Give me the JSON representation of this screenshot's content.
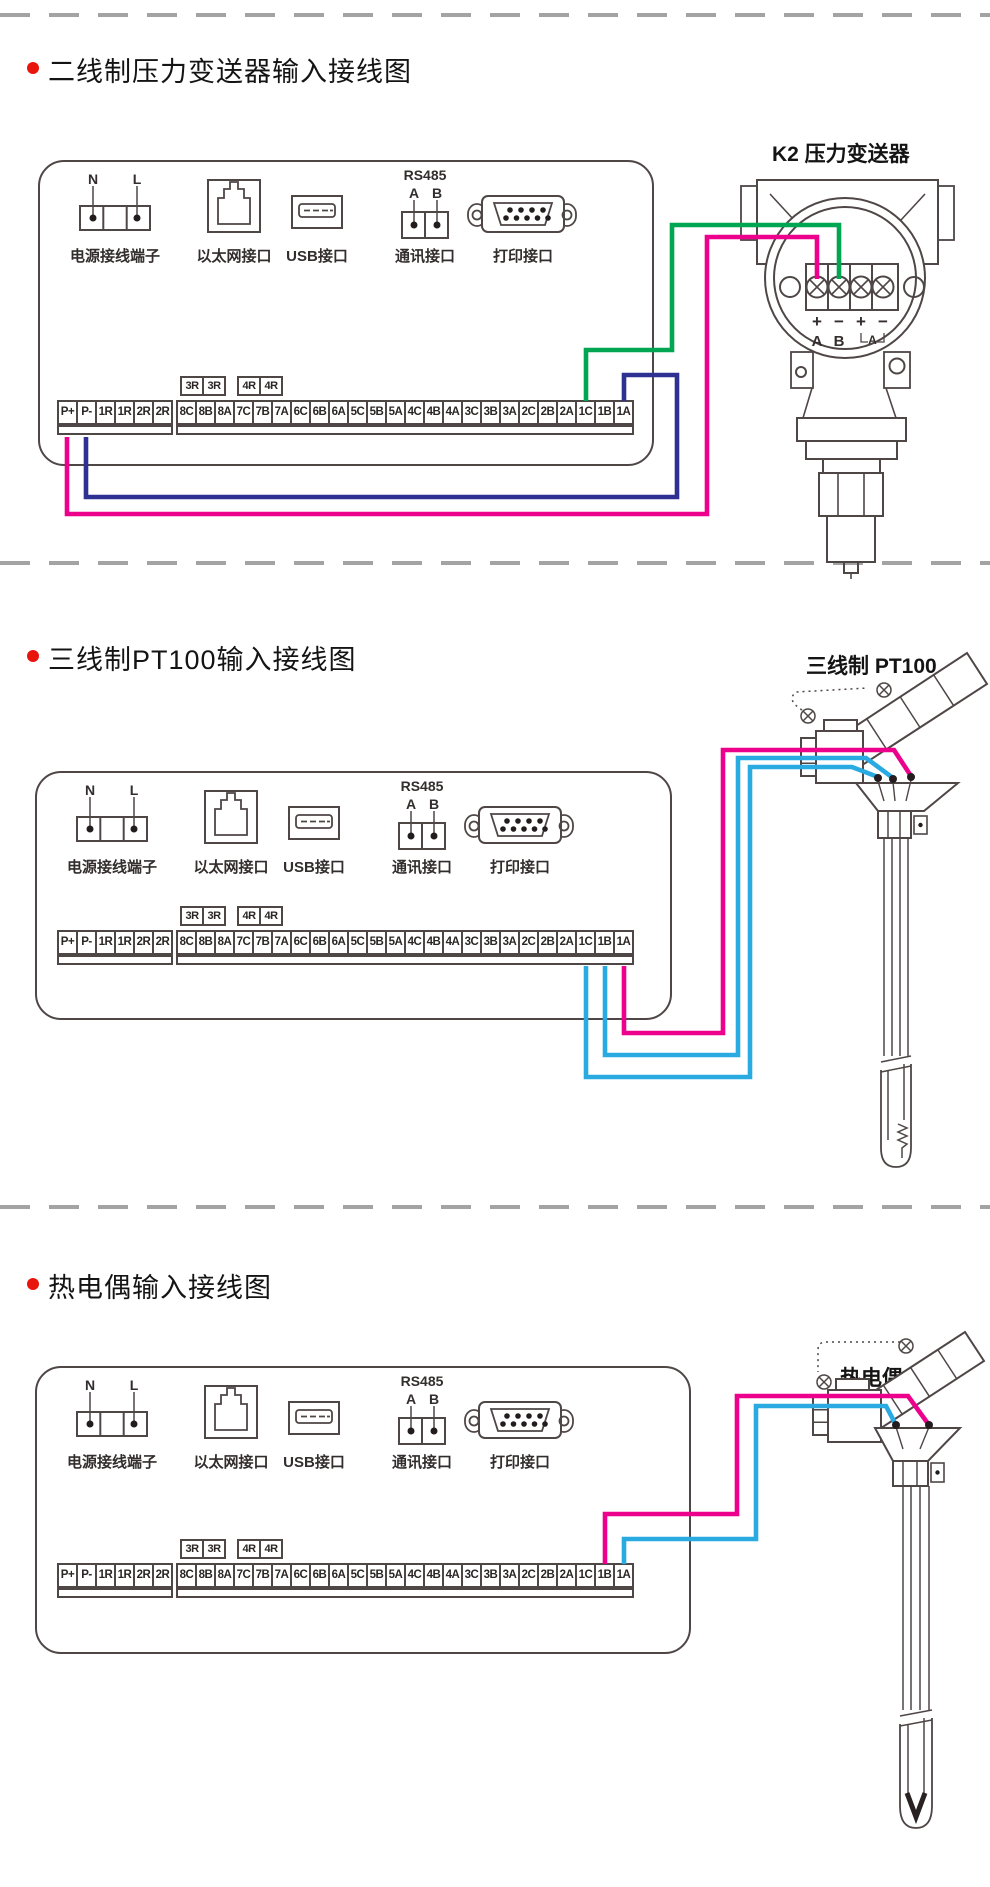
{
  "colors": {
    "wire_magenta": "#ec008c",
    "wire_blue": "#2e3192",
    "wire_green": "#00a651",
    "wire_cyan": "#29abe2",
    "bullet_red": "#e8150d",
    "outline": "#4f4646"
  },
  "sections": [
    {
      "title": "二线制压力变送器输入接线图",
      "device_label": "K2 压力变送器"
    },
    {
      "title": "三线制PT100输入接线图",
      "device_label": "三线制 PT100"
    },
    {
      "title": "热电偶输入接线图",
      "device_label": "热电偶 TC"
    }
  ],
  "panel": {
    "power_n": "N",
    "power_l": "L",
    "power_label": "电源接线端子",
    "ethernet_label": "以太网接口",
    "usb_label": "USB接口",
    "rs485": "RS485",
    "rs485_a": "A",
    "rs485_b": "B",
    "comm_label": "通讯接口",
    "printer_label": "打印接口"
  },
  "terminal_strip": {
    "left_cells": [
      "P+",
      "P-",
      "1R",
      "1R",
      "2R",
      "2R"
    ],
    "relay_cells_3": [
      "3R",
      "3R"
    ],
    "relay_cells_4": [
      "4R",
      "4R"
    ],
    "main_cells": [
      "8C",
      "8B",
      "8A",
      "7C",
      "7B",
      "7A",
      "6C",
      "6B",
      "6A",
      "5C",
      "5B",
      "5A",
      "4C",
      "4B",
      "4A",
      "3C",
      "3B",
      "3A",
      "2C",
      "2B",
      "2A",
      "1C",
      "1B",
      "1A"
    ]
  },
  "transmitter": {
    "terminal_polarity": [
      "+",
      "−",
      "+",
      "−"
    ],
    "terminal_ab": [
      "A",
      "B"
    ],
    "bracket_label": "A"
  }
}
